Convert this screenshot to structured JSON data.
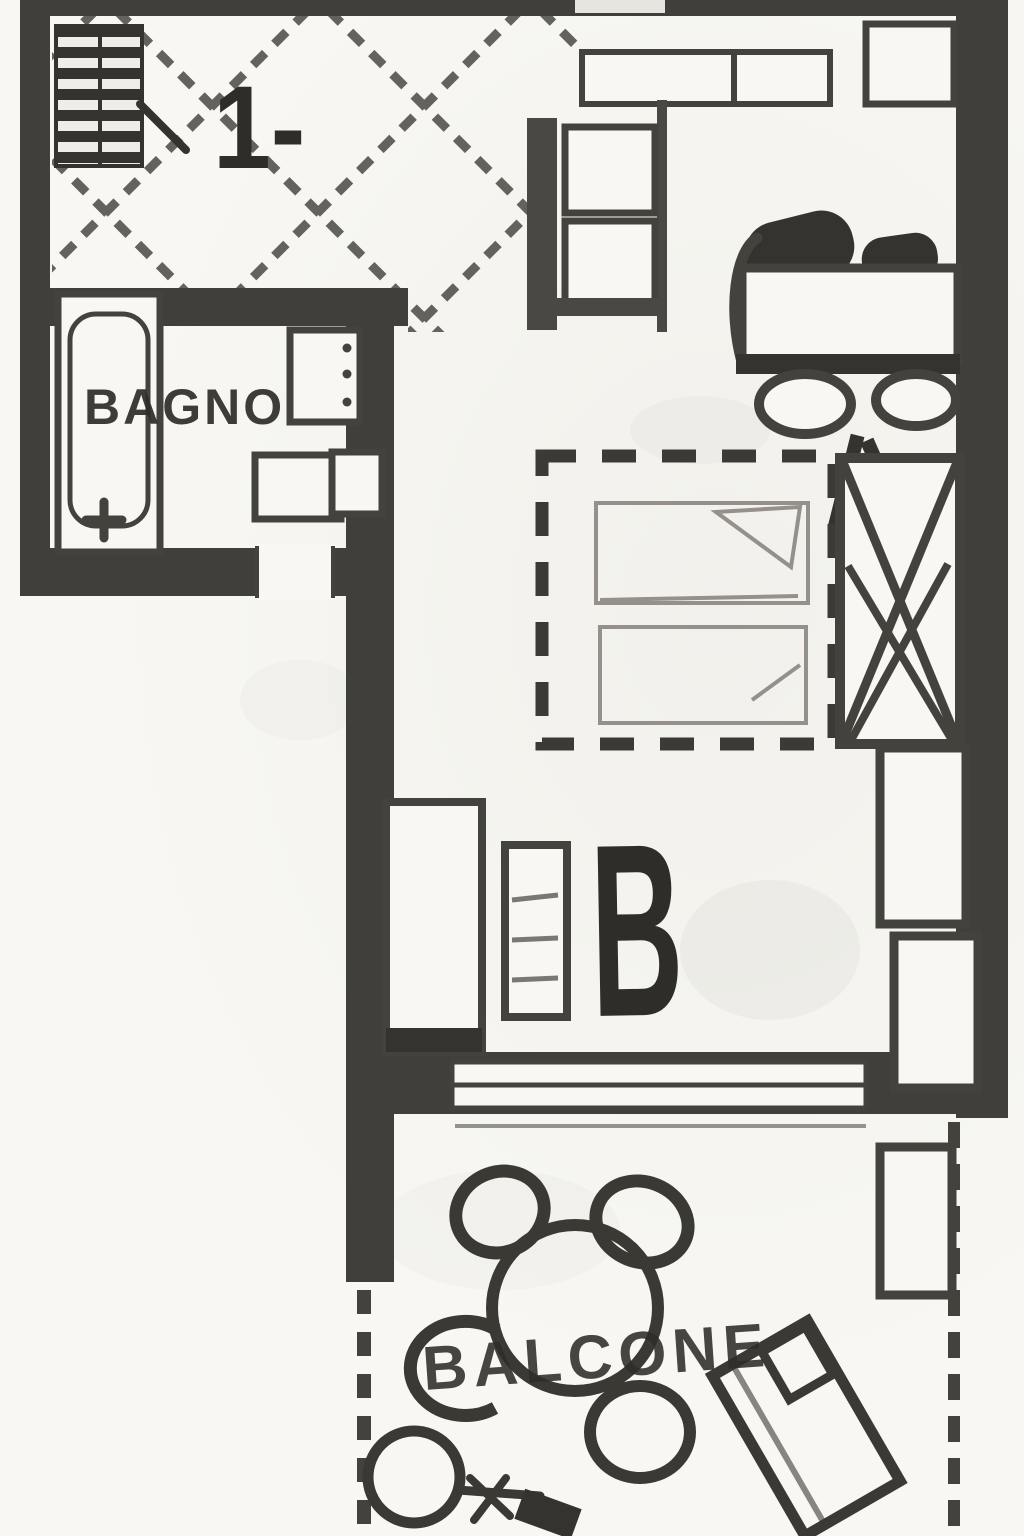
{
  "plan": {
    "labels": {
      "unit": "1-",
      "bathroom": "BAGNO",
      "room_mark": "B",
      "balcony": "BALCONE"
    },
    "colors": {
      "paper": "#f8f7f3",
      "wall": "#413f3b",
      "ink": "#44423d",
      "light_ink": "#95908a",
      "label_ink": "#2e2d2a"
    },
    "symbols": [
      "stairs-hatch",
      "tiled-floor-lattice",
      "wall-cabinet",
      "kitchen-unit",
      "bathtub",
      "toilet",
      "bidet",
      "door-opening",
      "sofa",
      "double-bed-dashed",
      "wardrobe-crossed",
      "side-cabinet",
      "radiator",
      "door-frame",
      "sliding-glass-door",
      "balcony-window",
      "round-table",
      "chair",
      "potted-plant",
      "sun-lounger",
      "railing-dashed"
    ]
  }
}
